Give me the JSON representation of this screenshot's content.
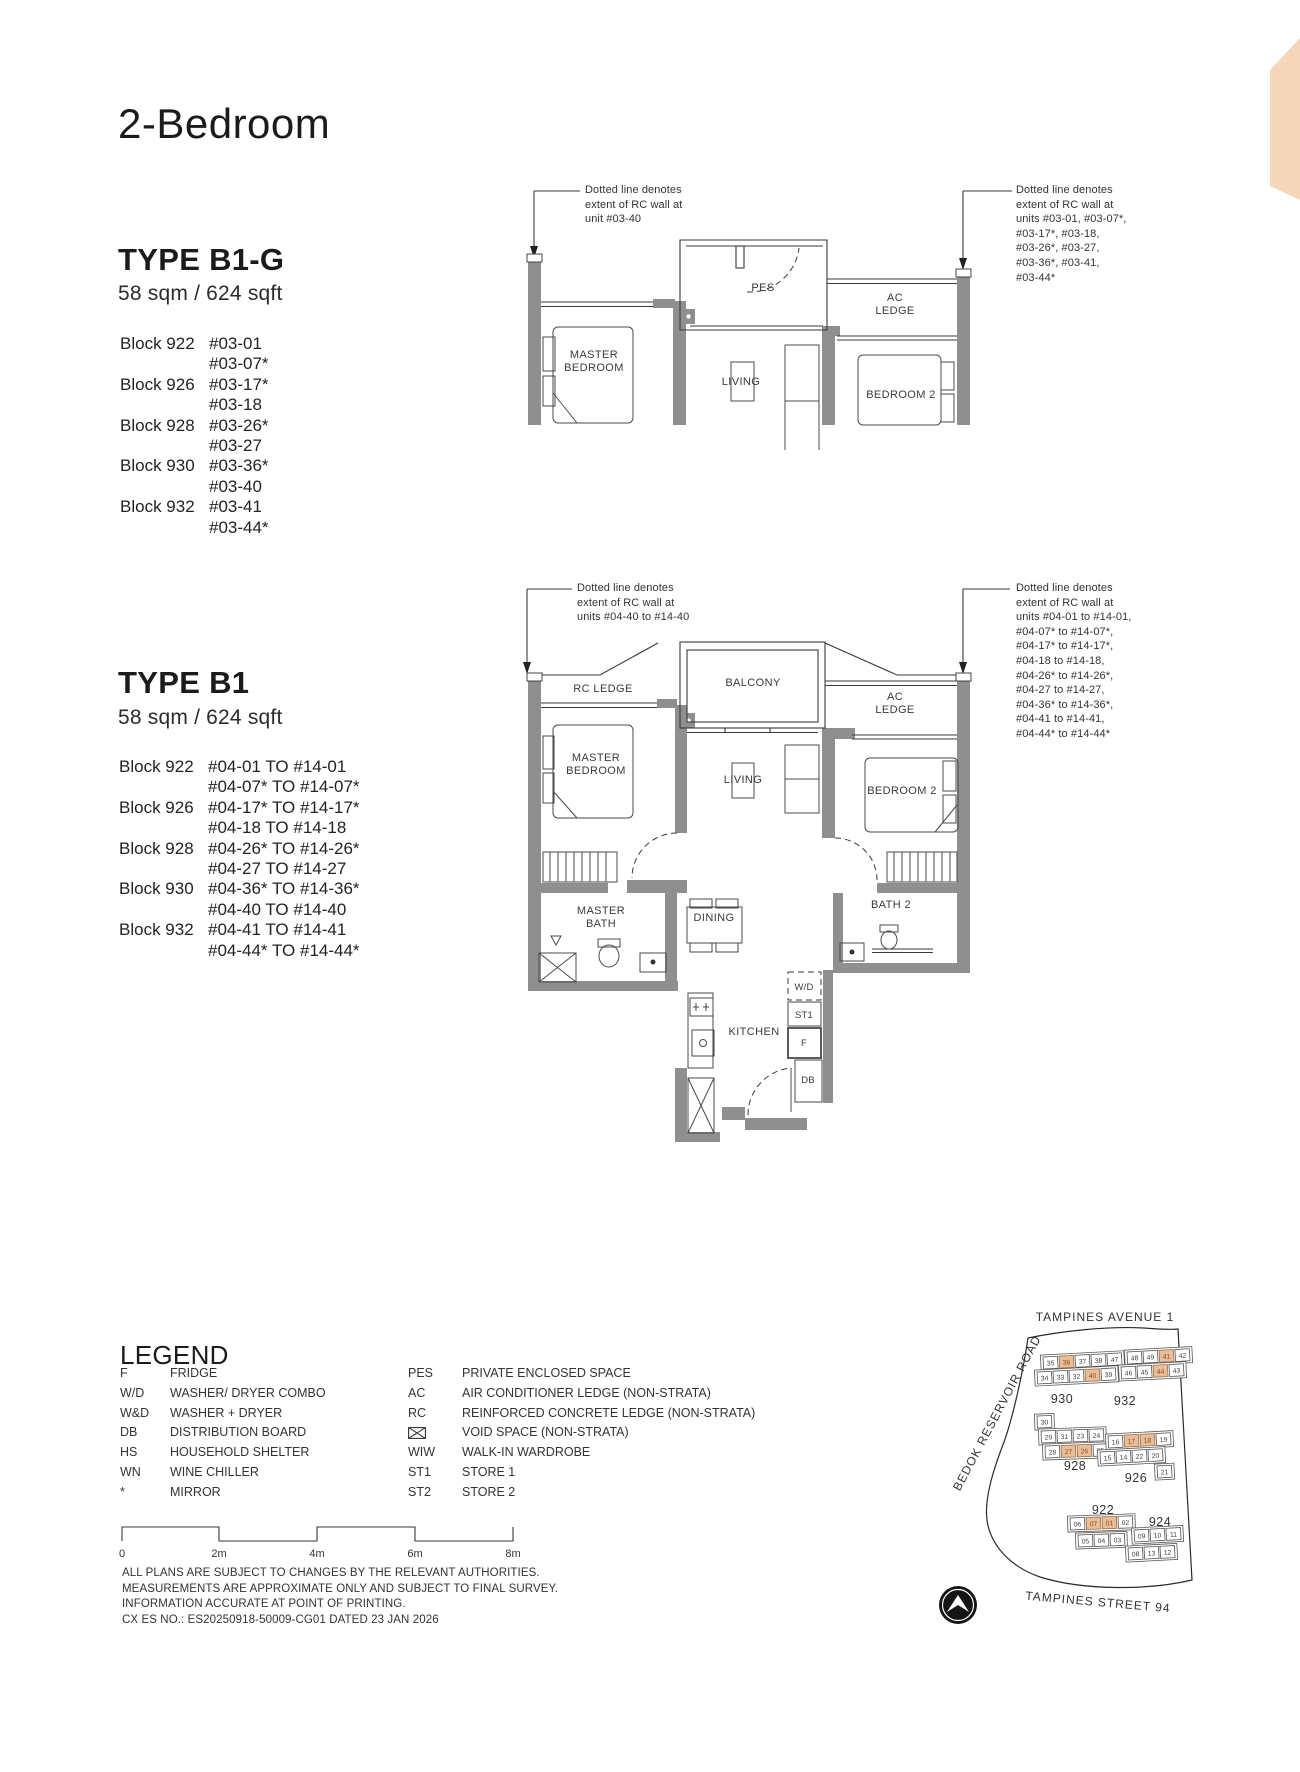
{
  "page": {
    "title": "2-Bedroom"
  },
  "b1g": {
    "name": "TYPE B1-G",
    "area": "58 sqm / 624 sqft",
    "blocks": [
      {
        "block": "Block 922",
        "units": [
          "#03-01",
          "#03-07*"
        ]
      },
      {
        "block": "Block 926",
        "units": [
          "#03-17*",
          "#03-18"
        ]
      },
      {
        "block": "Block 928",
        "units": [
          "#03-26*",
          "#03-27"
        ]
      },
      {
        "block": "Block 930",
        "units": [
          "#03-36*",
          "#03-40"
        ]
      },
      {
        "block": "Block 932",
        "units": [
          "#03-41",
          "#03-44*"
        ]
      }
    ],
    "annotation_left": "Dotted line denotes\nextent of RC wall at\nunit #03-40",
    "annotation_right": "Dotted line denotes\nextent of RC wall at\nunits #03-01, #03-07*,\n#03-17*, #03-18,\n#03-26*, #03-27,\n#03-36*, #03-41,\n#03-44*",
    "rooms": {
      "master_bedroom": "MASTER BEDROOM",
      "pes": "PES",
      "living": "LIVING",
      "ac_ledge": "AC LEDGE",
      "bedroom2": "BEDROOM 2"
    }
  },
  "b1": {
    "name": "TYPE B1",
    "area": "58 sqm / 624 sqft",
    "blocks": [
      {
        "block": "Block 922",
        "units": [
          "#04-01 TO #14-01",
          "#04-07* TO #14-07*"
        ]
      },
      {
        "block": "Block 926",
        "units": [
          "#04-17* TO #14-17*",
          "#04-18 TO #14-18"
        ]
      },
      {
        "block": "Block 928",
        "units": [
          "#04-26* TO #14-26*",
          "#04-27 TO #14-27"
        ]
      },
      {
        "block": "Block 930",
        "units": [
          "#04-36* TO #14-36*",
          "#04-40 TO #14-40"
        ]
      },
      {
        "block": "Block 932",
        "units": [
          "#04-41 TO #14-41",
          "#04-44* TO #14-44*"
        ]
      }
    ],
    "annotation_left": "Dotted line denotes\nextent of RC wall at\nunits #04-40 to #14-40",
    "annotation_right": "Dotted line denotes\nextent of RC wall at\nunits #04-01 to #14-01,\n#04-07* to #14-07*,\n#04-17* to #14-17*,\n#04-18 to #14-18,\n#04-26* to #14-26*,\n#04-27 to #14-27,\n#04-36* to #14-36*,\n#04-41 to #14-41,\n#04-44* to #14-44*",
    "rooms": {
      "rc_ledge": "RC LEDGE",
      "balcony": "BALCONY",
      "ac_ledge": "AC LEDGE",
      "master_bedroom": "MASTER BEDROOM",
      "living": "LIVING",
      "bedroom2": "BEDROOM 2",
      "master_bath": "MASTER BATH",
      "dining": "DINING",
      "bath2": "BATH 2",
      "kitchen": "KITCHEN",
      "wd": "W/D",
      "st1": "ST1",
      "f": "F",
      "db": "DB"
    }
  },
  "legend": {
    "title": "LEGEND",
    "left": [
      [
        "F",
        "FRIDGE"
      ],
      [
        "W/D",
        "WASHER/ DRYER COMBO"
      ],
      [
        "W&D",
        "WASHER + DRYER"
      ],
      [
        "DB",
        "DISTRIBUTION BOARD"
      ],
      [
        "HS",
        "HOUSEHOLD SHELTER"
      ],
      [
        "WN",
        "WINE CHILLER"
      ],
      [
        "*",
        "MIRROR"
      ]
    ],
    "right": [
      [
        "PES",
        "PRIVATE ENCLOSED SPACE"
      ],
      [
        "AC",
        "AIR CONDITIONER LEDGE (NON-STRATA)"
      ],
      [
        "RC",
        "REINFORCED CONCRETE LEDGE (NON-STRATA)"
      ],
      [
        "VOID-ICON",
        "VOID SPACE (NON-STRATA)"
      ],
      [
        "WIW",
        "WALK-IN WARDROBE"
      ],
      [
        "ST1",
        "STORE 1"
      ],
      [
        "ST2",
        "STORE 2"
      ]
    ]
  },
  "scale": {
    "labels": [
      "0",
      "2m",
      "4m",
      "6m",
      "8m"
    ]
  },
  "disclaimer": "ALL PLANS ARE SUBJECT TO CHANGES BY THE RELEVANT AUTHORITIES.\nMEASUREMENTS ARE APPROXIMATE ONLY AND SUBJECT TO FINAL SURVEY.\nINFORMATION ACCURATE AT POINT OF PRINTING.\nCX ES NO.: ES20250918-50009-CG01 DATED 23 JAN 2026",
  "sitemap": {
    "roads": {
      "top": "TAMPINES AVENUE 1",
      "left": "BEDOK RESERVOIR ROAD",
      "bottom": "TAMPINES STREET 94"
    },
    "blocks": [
      {
        "id": "930",
        "label": "930",
        "rows": [
          [
            "35",
            "36*",
            "37",
            "38",
            "47"
          ],
          [
            "34",
            "33",
            "32",
            "40*",
            "39"
          ]
        ]
      },
      {
        "id": "932",
        "label": "932",
        "rows": [
          [
            "48",
            "49",
            "41*",
            "42"
          ],
          [
            "46",
            "45",
            "44*",
            "43"
          ]
        ]
      },
      {
        "id": "928",
        "label": "928",
        "rows": [
          [
            "30"
          ],
          [
            "29",
            "31",
            "23",
            "24"
          ],
          [
            "28",
            "27*",
            "26*",
            "25"
          ]
        ]
      },
      {
        "id": "926",
        "label": "926",
        "rows": [
          [
            "16",
            "17*",
            "18*",
            "19"
          ],
          [
            "15",
            "14",
            "22",
            "20"
          ],
          [
            "21"
          ]
        ]
      },
      {
        "id": "922",
        "label": "922",
        "rows": [
          [
            "06",
            "07*",
            "01*",
            "02"
          ],
          [
            "05",
            "04",
            "03"
          ]
        ]
      },
      {
        "id": "924",
        "label": "924",
        "rows": [
          [
            "09",
            "10",
            "11"
          ],
          [
            "08",
            "13",
            "12"
          ]
        ]
      }
    ]
  },
  "colors": {
    "accent_corner": "#f4d7ba",
    "wall": "#8f8f8f",
    "unit_highlight": "#e9bd97",
    "unit_highlight_text": "#8a4d1f"
  }
}
